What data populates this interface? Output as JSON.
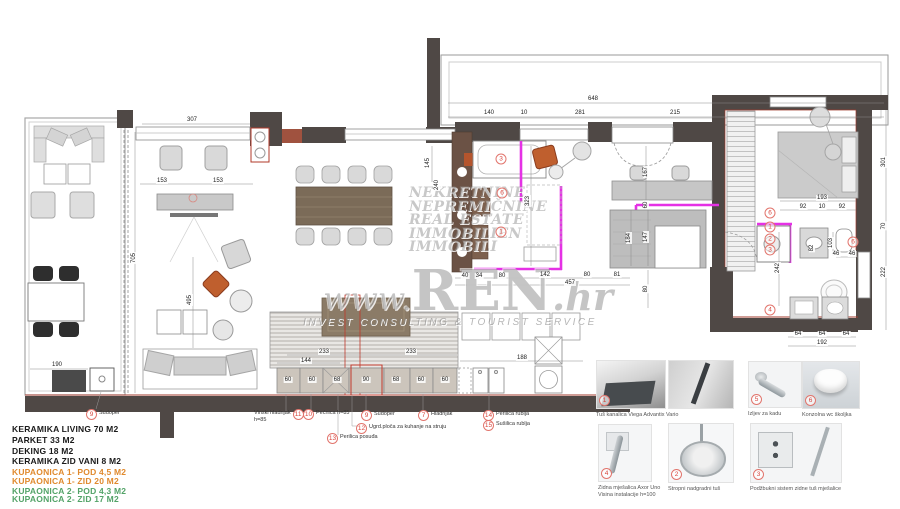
{
  "colors": {
    "wall": "#4f4845",
    "accent_red": "#a03b2e",
    "tile_magenta": "#e531e5",
    "marker_red": "#d9453c",
    "legend_black": "#1a1a1a",
    "legend_orange": "#e08a2e",
    "legend_green": "#53a368",
    "furniture_gray": "#d8d8d8",
    "table_wood": "#7b6b58"
  },
  "watermark": {
    "lines": [
      "NEKRETNINE",
      "NEPREMIČNINE",
      "REAL ESTATE",
      "IMMOBILIEN",
      "IMMOBILI"
    ],
    "brand_www": "www.",
    "brand_ren": "REN",
    "brand_hr": ".hr",
    "tagline": "INVEST CONSULTING & TOURIST SERVICE"
  },
  "legend": {
    "items": [
      {
        "text": "KERAMIKA LIVING 70 M2",
        "color": "#1a1a1a",
        "y": 424
      },
      {
        "text": "PARKET 33 M2",
        "color": "#1a1a1a",
        "y": 435
      },
      {
        "text": "DEKING 18 M2",
        "color": "#1a1a1a",
        "y": 446
      },
      {
        "text": "KERAMIKA ZID VANI 8 M2",
        "color": "#1a1a1a",
        "y": 456
      },
      {
        "text": "KUPAONICA 1- POD 4,5 M2",
        "color": "#e08a2e",
        "y": 467
      },
      {
        "text": "KUPAONICA 1- ZID 20 M2",
        "color": "#e08a2e",
        "y": 476
      },
      {
        "text": "KUPAONICA 2- POD 4,3 M2",
        "color": "#53a368",
        "y": 486
      },
      {
        "text": "KUPAONICA 2- ZID 17 M2",
        "color": "#53a368",
        "y": 494
      }
    ]
  },
  "appliance_labels": [
    {
      "num": "9",
      "lines": [
        "Sudoper"
      ],
      "x": 86,
      "y": 409,
      "after": false
    },
    {
      "num": "11",
      "lines": [
        "Vinski hladnjak",
        "h=85"
      ],
      "x": 254,
      "y": 409,
      "after": true
    },
    {
      "num": "10",
      "lines": [
        "Pećnica h=85"
      ],
      "x": 303,
      "y": 409,
      "after": false
    },
    {
      "num": "9",
      "lines": [
        "Sudoper"
      ],
      "x": 361,
      "y": 410,
      "after": false
    },
    {
      "num": "12",
      "lines": [
        "Ugrd.ploča za kuhanje na struju"
      ],
      "x": 356,
      "y": 423,
      "after": false
    },
    {
      "num": "13",
      "lines": [
        "Perilica posuđa"
      ],
      "x": 327,
      "y": 433,
      "after": false
    },
    {
      "num": "7",
      "lines": [
        "Hladnjak"
      ],
      "x": 418,
      "y": 410,
      "after": false
    },
    {
      "num": "14",
      "lines": [
        "Perilica rublja"
      ],
      "x": 483,
      "y": 410,
      "after": false
    },
    {
      "num": "15",
      "lines": [
        "Sušilica rublja"
      ],
      "x": 483,
      "y": 420,
      "after": false
    }
  ],
  "plan_markers": [
    {
      "num": "3",
      "x": 501,
      "y": 159
    },
    {
      "num": "6",
      "x": 502,
      "y": 193
    },
    {
      "num": "1",
      "x": 501,
      "y": 232
    },
    {
      "num": "6",
      "x": 770,
      "y": 213
    },
    {
      "num": "1",
      "x": 770,
      "y": 227
    },
    {
      "num": "2",
      "x": 770,
      "y": 239
    },
    {
      "num": "3",
      "x": 770,
      "y": 250
    },
    {
      "num": "6",
      "x": 853,
      "y": 242
    },
    {
      "num": "4",
      "x": 770,
      "y": 310
    }
  ],
  "dimensions": [
    {
      "t": "648",
      "x": 593,
      "y": 99
    },
    {
      "t": "140",
      "x": 489,
      "y": 113
    },
    {
      "t": "10",
      "x": 524,
      "y": 113
    },
    {
      "t": "281",
      "x": 580,
      "y": 113
    },
    {
      "t": "215",
      "x": 675,
      "y": 113
    },
    {
      "t": "307",
      "x": 192,
      "y": 120
    },
    {
      "t": "153",
      "x": 162,
      "y": 181
    },
    {
      "t": "153",
      "x": 218,
      "y": 181
    },
    {
      "t": "705",
      "x": 134,
      "y": 258,
      "v": true
    },
    {
      "t": "495",
      "x": 190,
      "y": 300,
      "v": true
    },
    {
      "t": "190",
      "x": 57,
      "y": 365
    },
    {
      "t": "145",
      "x": 428,
      "y": 163,
      "v": true
    },
    {
      "t": "240",
      "x": 437,
      "y": 185,
      "v": true
    },
    {
      "t": "323",
      "x": 528,
      "y": 201,
      "v": true
    },
    {
      "t": "40",
      "x": 465,
      "y": 276
    },
    {
      "t": "34",
      "x": 479,
      "y": 276
    },
    {
      "t": "80",
      "x": 502,
      "y": 276
    },
    {
      "t": "142",
      "x": 545,
      "y": 275
    },
    {
      "t": "80",
      "x": 587,
      "y": 275
    },
    {
      "t": "81",
      "x": 617,
      "y": 275
    },
    {
      "t": "457",
      "x": 570,
      "y": 283
    },
    {
      "t": "167",
      "x": 646,
      "y": 172,
      "v": true
    },
    {
      "t": "60",
      "x": 646,
      "y": 205,
      "v": true
    },
    {
      "t": "184",
      "x": 629,
      "y": 238,
      "v": true
    },
    {
      "t": "147",
      "x": 646,
      "y": 237,
      "v": true
    },
    {
      "t": "80",
      "x": 646,
      "y": 289,
      "v": true
    },
    {
      "t": "193",
      "x": 822,
      "y": 198
    },
    {
      "t": "92",
      "x": 803,
      "y": 207
    },
    {
      "t": "10",
      "x": 822,
      "y": 207
    },
    {
      "t": "92",
      "x": 842,
      "y": 207
    },
    {
      "t": "301",
      "x": 884,
      "y": 162,
      "v": true
    },
    {
      "t": "70",
      "x": 884,
      "y": 226,
      "v": true
    },
    {
      "t": "222",
      "x": 884,
      "y": 272,
      "v": true
    },
    {
      "t": "242",
      "x": 778,
      "y": 268,
      "v": true
    },
    {
      "t": "103",
      "x": 831,
      "y": 243,
      "v": true
    },
    {
      "t": "82",
      "x": 812,
      "y": 248,
      "v": true
    },
    {
      "t": "46",
      "x": 836,
      "y": 254
    },
    {
      "t": "46",
      "x": 852,
      "y": 254
    },
    {
      "t": "64",
      "x": 798,
      "y": 334
    },
    {
      "t": "64",
      "x": 822,
      "y": 334
    },
    {
      "t": "64",
      "x": 846,
      "y": 334
    },
    {
      "t": "192",
      "x": 822,
      "y": 343
    },
    {
      "t": "233",
      "x": 324,
      "y": 352
    },
    {
      "t": "233",
      "x": 411,
      "y": 352
    },
    {
      "t": "144",
      "x": 306,
      "y": 361
    },
    {
      "t": "188",
      "x": 522,
      "y": 358
    },
    {
      "t": "60",
      "x": 288,
      "y": 380
    },
    {
      "t": "60",
      "x": 312,
      "y": 380
    },
    {
      "t": "68",
      "x": 337,
      "y": 380
    },
    {
      "t": "90",
      "x": 366,
      "y": 380
    },
    {
      "t": "68",
      "x": 396,
      "y": 380
    },
    {
      "t": "60",
      "x": 421,
      "y": 380
    },
    {
      "t": "60",
      "x": 445,
      "y": 380
    }
  ],
  "products": {
    "items": [
      {
        "num": "1",
        "kind": "k-tray",
        "x": 596,
        "y": 360,
        "w": 68,
        "h": 47,
        "captions": [
          "Tuš kanalica Viega Advantix Vario"
        ]
      },
      {
        "num": "",
        "kind": "k-channel",
        "x": 668,
        "y": 360,
        "w": 64,
        "h": 47,
        "captions": []
      },
      {
        "num": "5",
        "kind": "k-spout",
        "x": 748,
        "y": 361,
        "w": 52,
        "h": 45,
        "captions": [
          "Izljev za kadu"
        ]
      },
      {
        "num": "6",
        "kind": "k-wc",
        "x": 802,
        "y": 361,
        "w": 56,
        "h": 46,
        "captions": [
          "Konzolna wc školjka"
        ]
      },
      {
        "num": "4",
        "kind": "k-mixer",
        "x": 598,
        "y": 424,
        "w": 52,
        "h": 56,
        "captions": [
          "Zidna mješalica Axor Uno",
          "Visina instalacije h=100"
        ]
      },
      {
        "num": "2",
        "kind": "k-headshower",
        "x": 668,
        "y": 423,
        "w": 64,
        "h": 58,
        "captions": [
          "Stropni nadgradni tuš"
        ]
      },
      {
        "num": "3",
        "kind": "k-valve",
        "x": 750,
        "y": 423,
        "w": 90,
        "h": 58,
        "captions": [
          "Podžbukni sistem zidne tuš mješalice"
        ]
      }
    ]
  }
}
